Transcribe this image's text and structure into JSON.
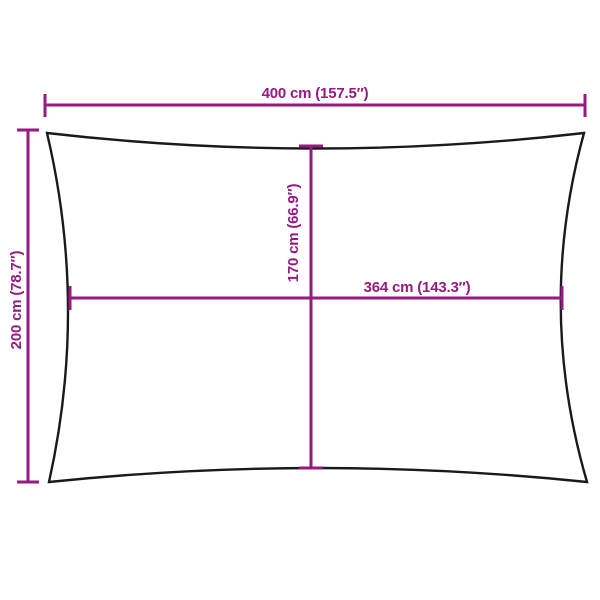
{
  "page": {
    "background_color": "#FFFFFF"
  },
  "diagram": {
    "subject": "rectangular shade sail dimension diagram",
    "accent_color": "#951B81",
    "outline_color": "#1A1A1A",
    "dimensions": {
      "overall_width": {
        "label": "400 cm (157.5″)",
        "cm": 400,
        "inches": 157.5,
        "orientation": "horizontal",
        "position": "top"
      },
      "overall_height": {
        "label": "200 cm (78.7″)",
        "cm": 200,
        "inches": 78.7,
        "orientation": "vertical",
        "position": "left"
      },
      "inner_height": {
        "label": "170 cm (66.9″)",
        "cm": 170,
        "inches": 66.9,
        "orientation": "vertical",
        "position": "center"
      },
      "inner_width": {
        "label": "364 cm (143.3″)",
        "cm": 364,
        "inches": 143.3,
        "orientation": "horizontal",
        "position": "center"
      }
    }
  }
}
